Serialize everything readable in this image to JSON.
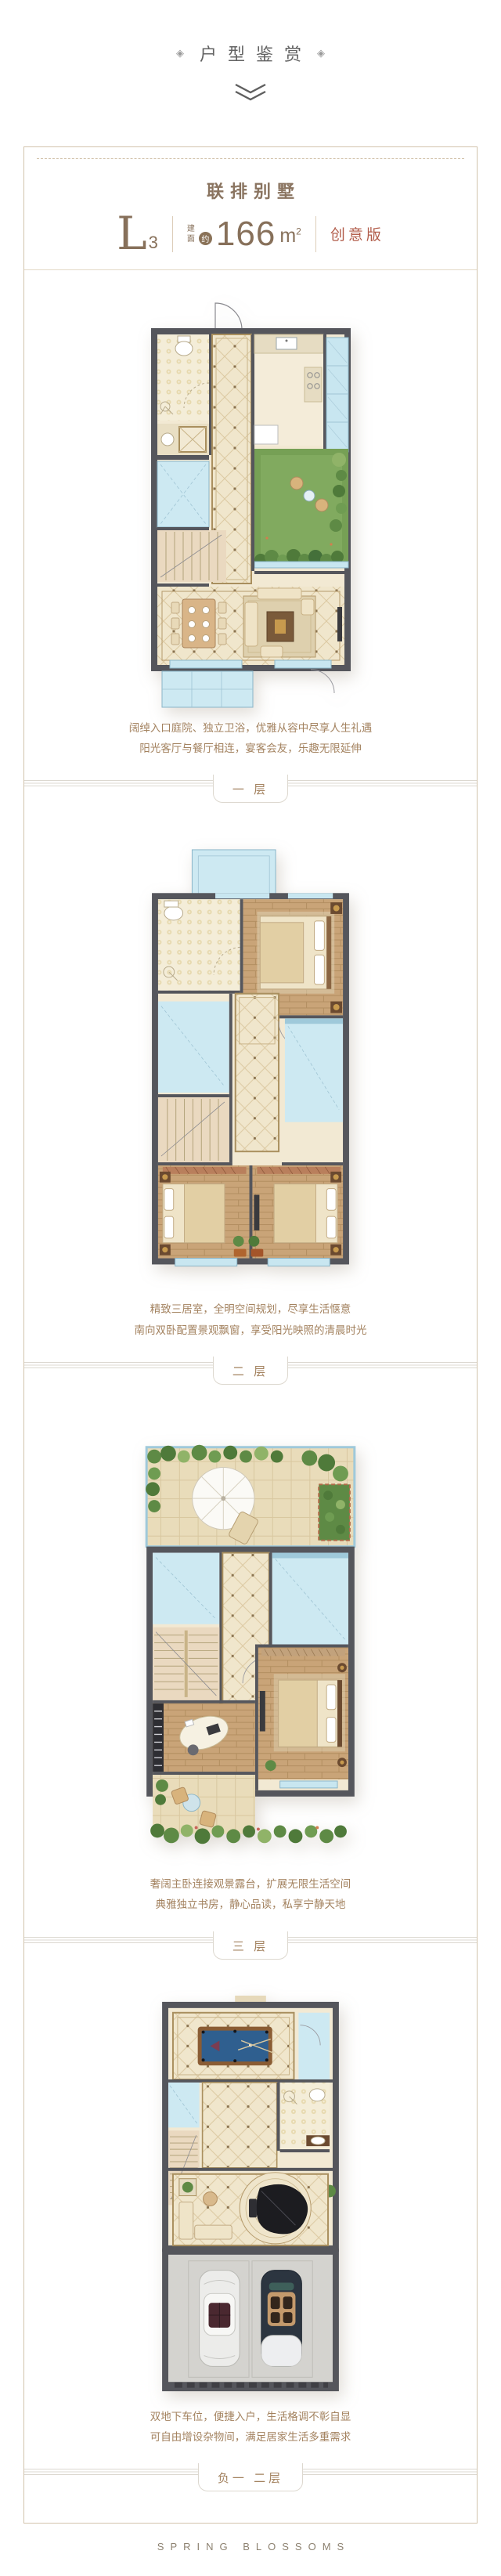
{
  "header": {
    "ornament_left": "◈",
    "ornament_right": "◈",
    "title": "户型鉴赏"
  },
  "building": {
    "section_title": "联排别墅"
  },
  "unit": {
    "model_letter": "L",
    "model_number": "3",
    "area_label_top": "建",
    "area_label_bottom": "面",
    "approx_badge": "约",
    "area_value": "166",
    "area_unit": "m",
    "area_superscript": "2",
    "edition_tag": "创意版"
  },
  "floors": [
    {
      "label": "一 层",
      "desc_line1": "阔绰入口庭院、独立卫浴，优雅从容中尽享人生礼遇",
      "desc_line2": "阳光客厅与餐厅相连，宴客会友，乐趣无限延伸"
    },
    {
      "label": "二 层",
      "desc_line1": "精致三居室，全明空间规划，尽享生活惬意",
      "desc_line2": "南向双卧配置景观飘窗，享受阳光映照的清晨时光"
    },
    {
      "label": "三 层",
      "desc_line1": "奢阔主卧连接观景露台，扩展无限生活空间",
      "desc_line2": "典雅独立书房，静心品读，私享宁静天地"
    },
    {
      "label": "负一 二层",
      "desc_line1": "双地下车位，便捷入户，生活格调不彰自显",
      "desc_line2": "可自由增设杂物间，满足居家生活多重需求"
    }
  ],
  "footer": {
    "brand": "SPRING BLOSSOMS"
  },
  "colors": {
    "accent_brown": "#87705a",
    "edition_red": "#b25d4b",
    "desc_text": "#a3825f",
    "frame_border": "#d2c3ac",
    "wall_gray": "#55565c",
    "window_blue": "#c8e6f0",
    "garden_green": "#76a055"
  }
}
